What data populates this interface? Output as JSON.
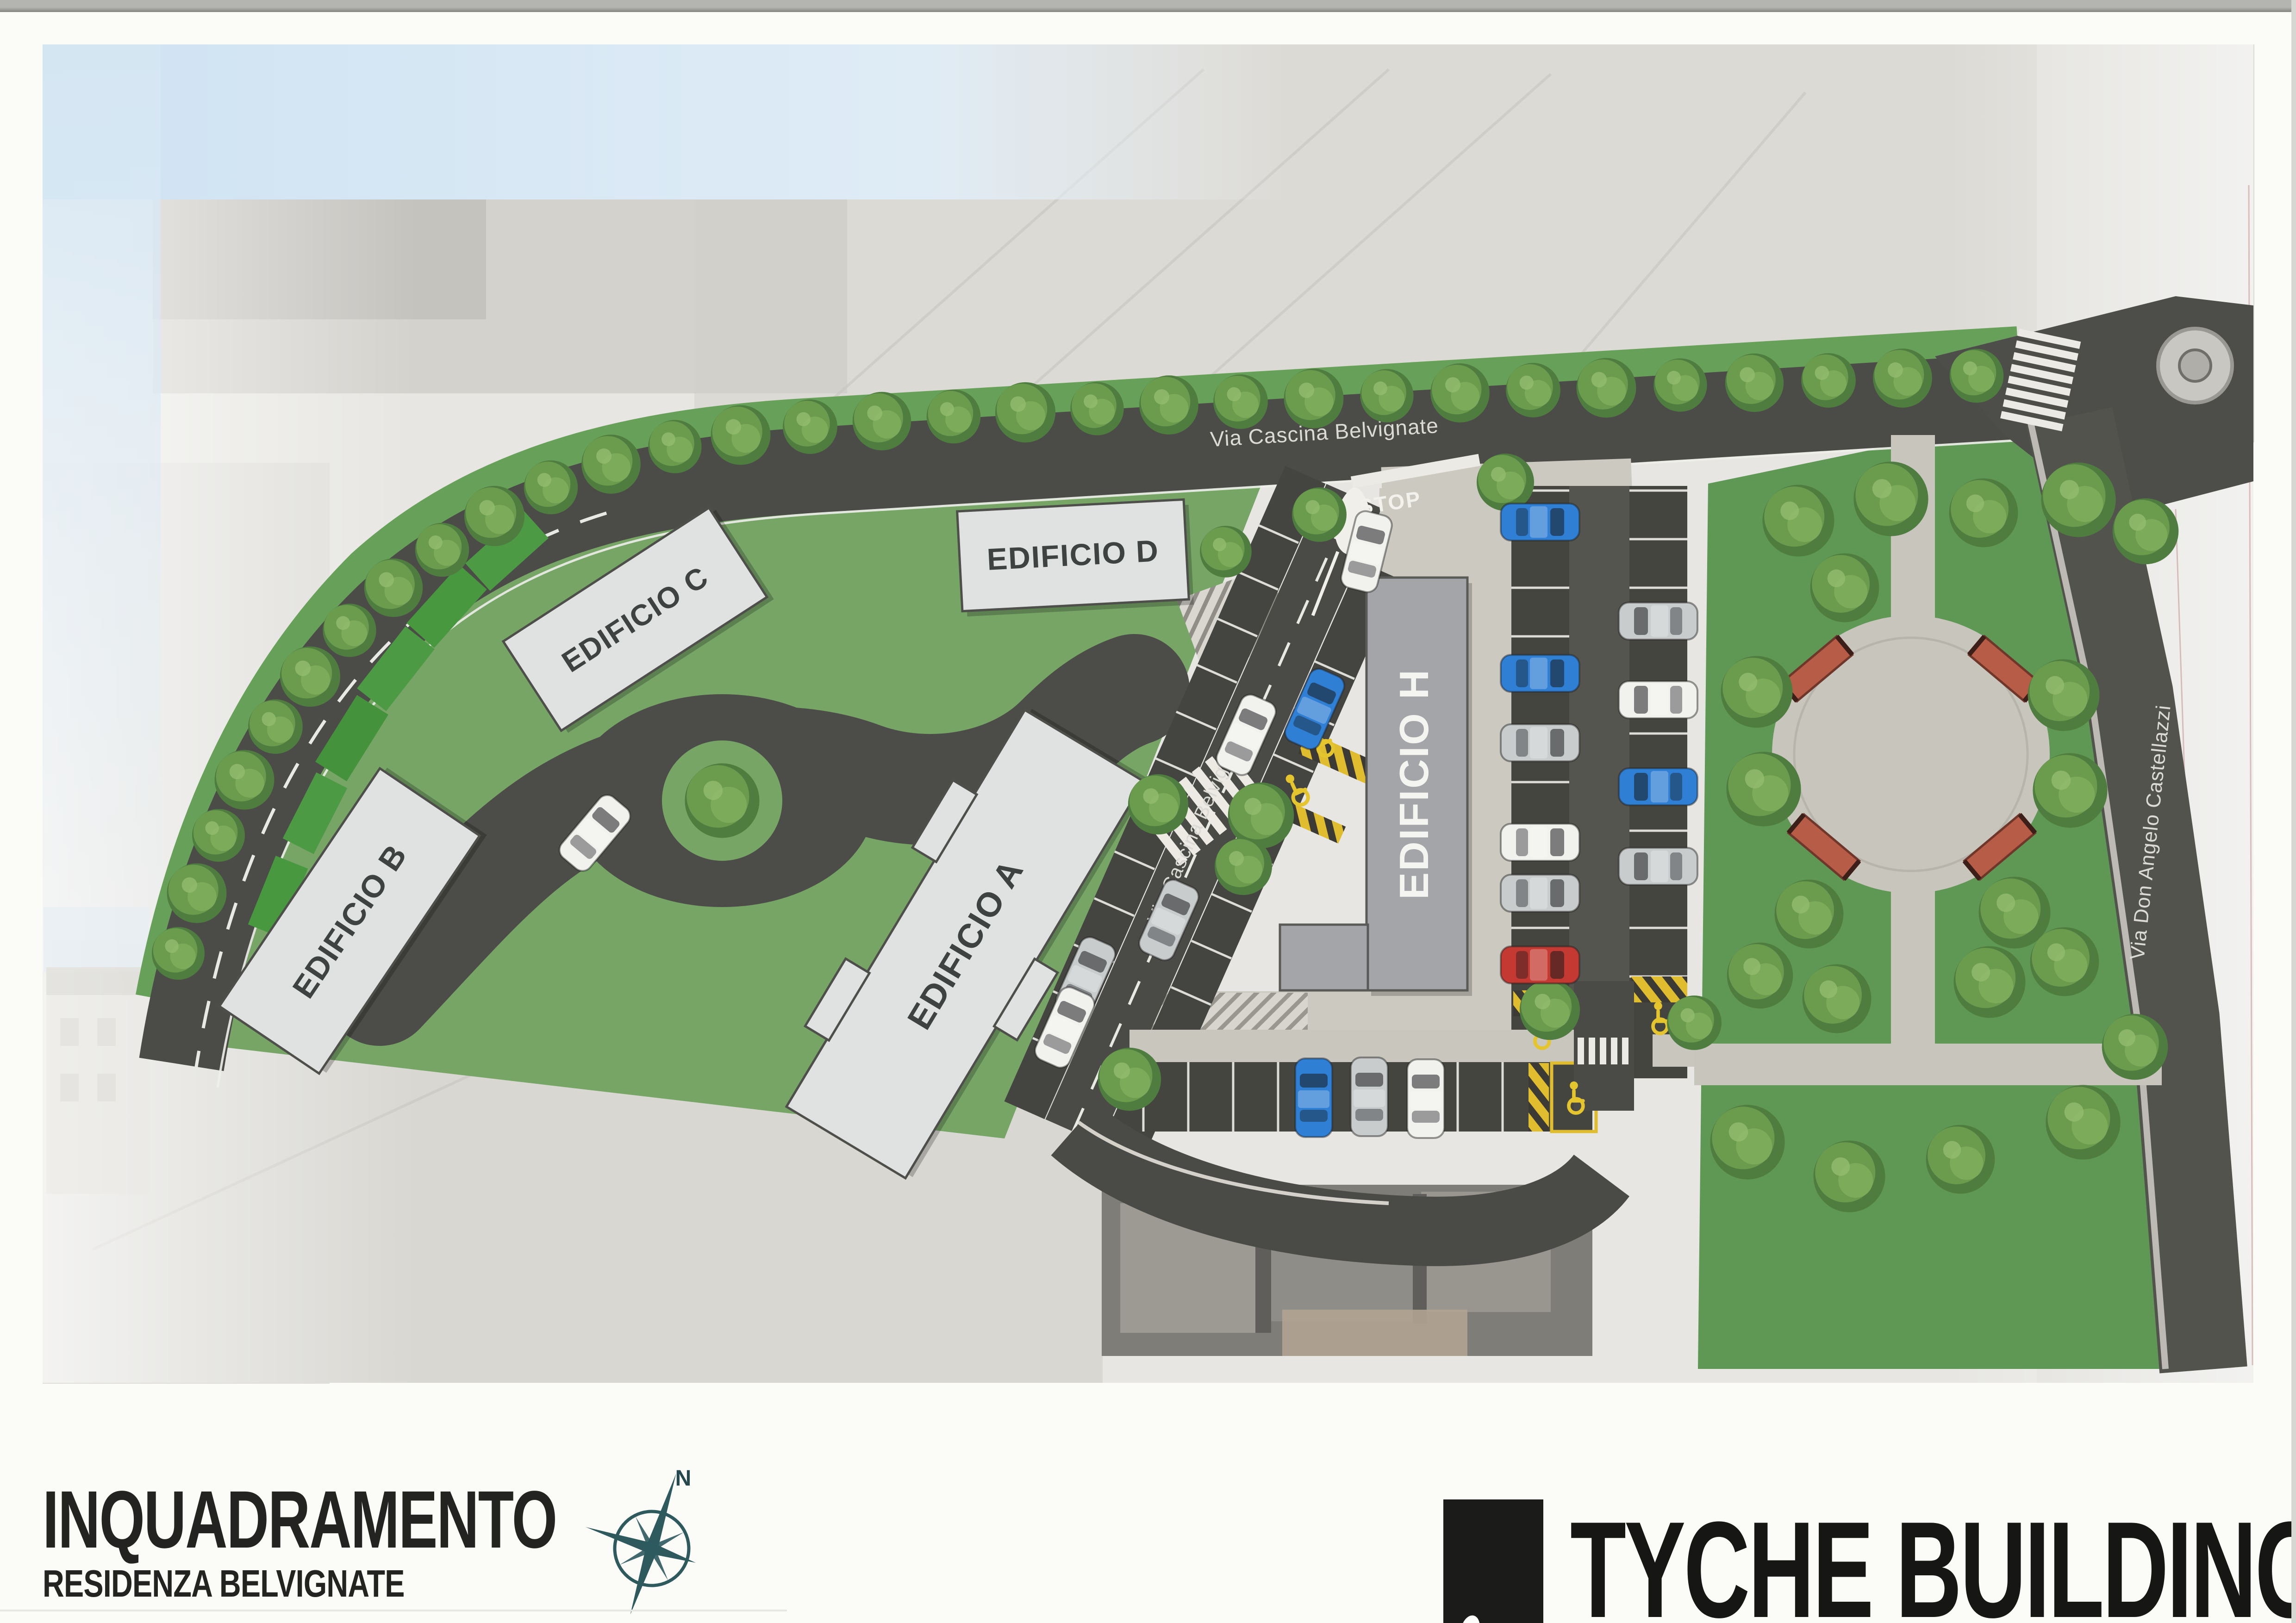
{
  "page": {
    "title": "INQUADRAMENTO",
    "subtitle": "RESIDENZA BELVIGNATE",
    "brand": "TYCHE BUILDING",
    "compass_north": "N"
  },
  "plan": {
    "buildings": [
      {
        "id": "A",
        "label": "EDIFICIO A"
      },
      {
        "id": "B",
        "label": "EDIFICIO B"
      },
      {
        "id": "C",
        "label": "EDIFICIO C"
      },
      {
        "id": "D",
        "label": "EDIFICIO D"
      },
      {
        "id": "H",
        "label": "EDIFICIO H"
      }
    ],
    "roads": {
      "top_label": "Via Cascina Belvignate",
      "lane_label": "Via Cascina Belvignate",
      "right_label": "Via Don Angelo Castellazzi"
    },
    "markings": {
      "stop": "STOP"
    },
    "colors": {
      "grass": "#76a566",
      "park_grass": "#5f9755",
      "asphalt": "#4b4b47",
      "paving": "#ccc9c1",
      "building_slab": "#e0e2e1",
      "building_h": "#a3a5a8",
      "disabled_yellow": "#e0bd2e",
      "bench_red": "#b65c47",
      "compass_teal": "#2e5a5e"
    }
  }
}
